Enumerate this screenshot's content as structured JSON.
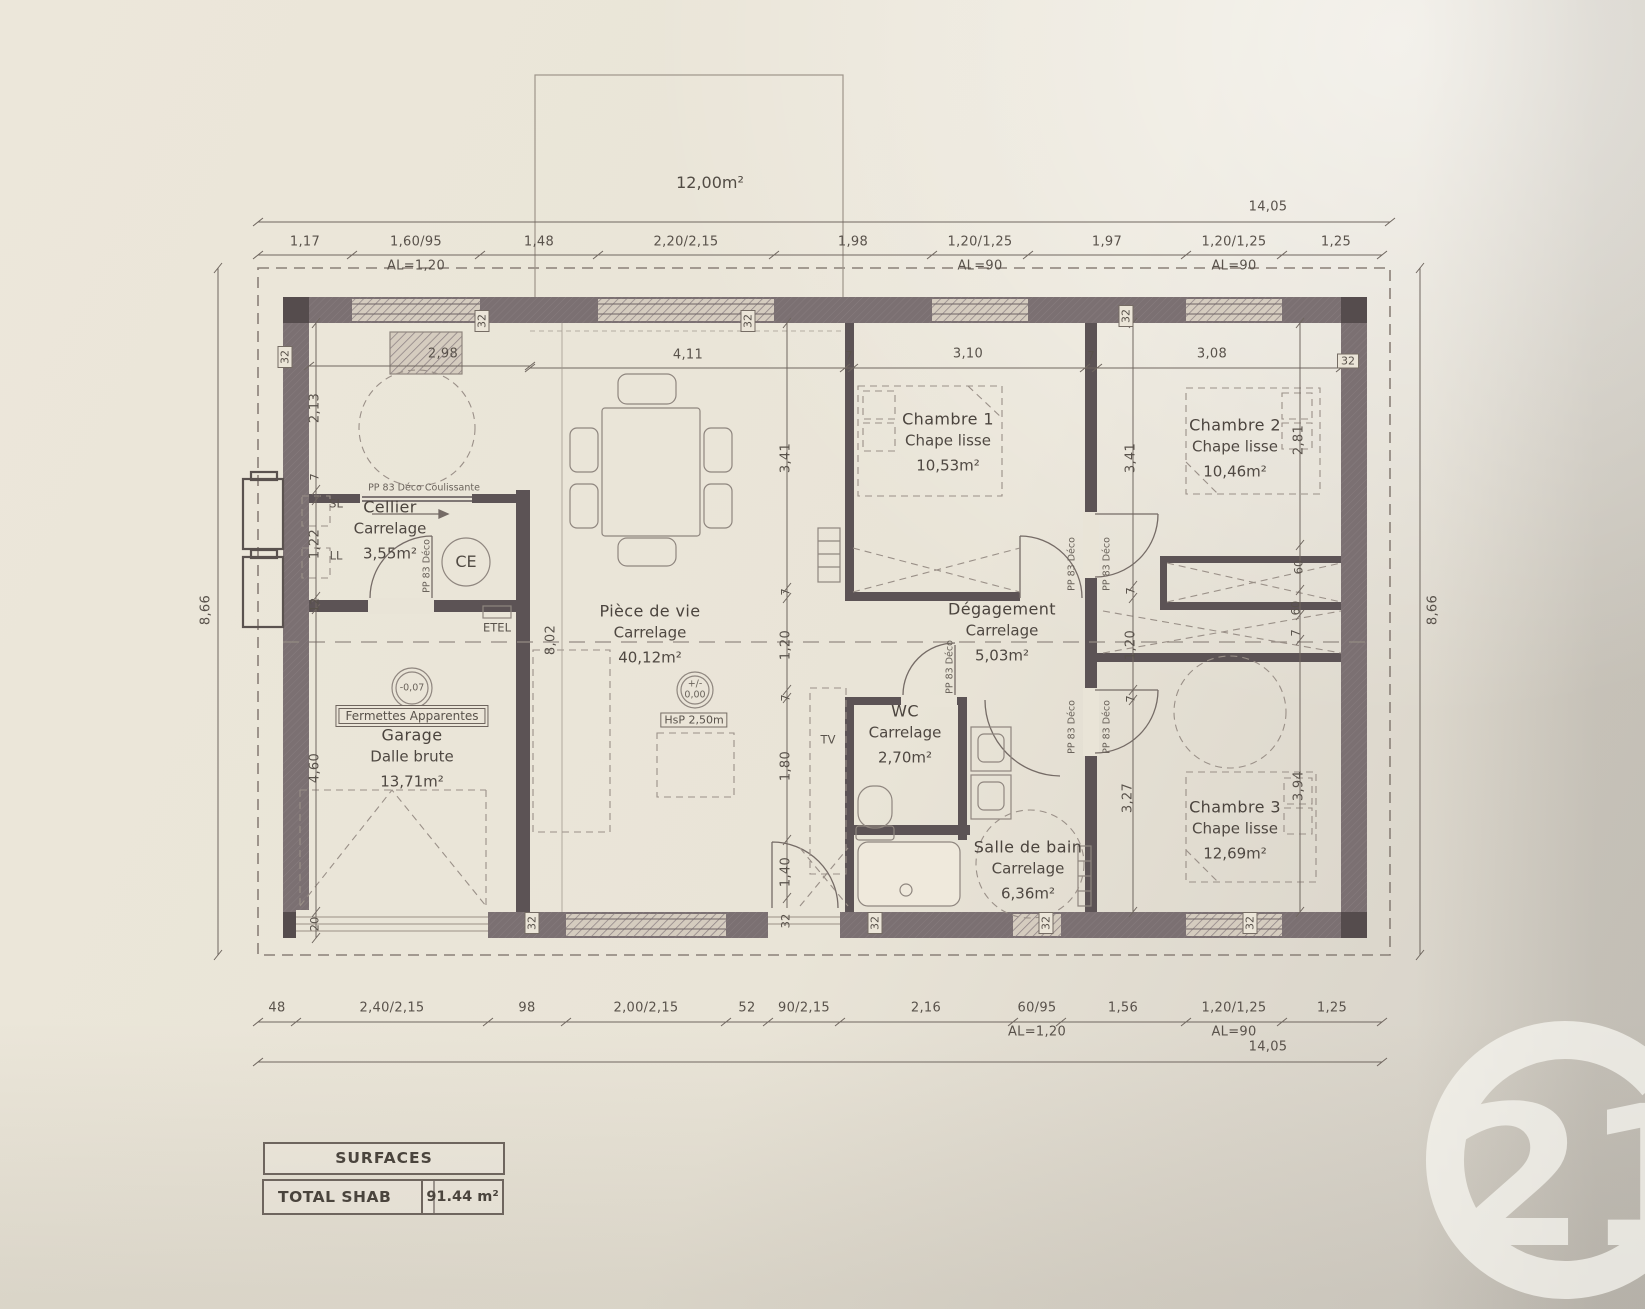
{
  "surfaces_table": {
    "header": "SURFACES",
    "total_label": "TOTAL SHAB",
    "total_value": "91.44 m²"
  },
  "watermark": {
    "number": "21"
  },
  "plan": {
    "terrace_area": "12,00m²",
    "overall_width": "14,05",
    "overall_height": "8,66",
    "rooms": [
      {
        "id": "cellier",
        "name": "Cellier",
        "finish": "Carrelage",
        "area": "3,55m²",
        "cx": 390,
        "cy": 530
      },
      {
        "id": "garage",
        "name": "Garage",
        "finish": "Dalle brute",
        "area": "13,71m²",
        "cx": 412,
        "cy": 758
      },
      {
        "id": "piece-de-vie",
        "name": "Pièce de vie",
        "finish": "Carrelage",
        "area": "40,12m²",
        "cx": 650,
        "cy": 634
      },
      {
        "id": "wc",
        "name": "WC",
        "finish": "Carrelage",
        "area": "2,70m²",
        "cx": 905,
        "cy": 734
      },
      {
        "id": "salle-de-bain",
        "name": "Salle de bain",
        "finish": "Carrelage",
        "area": "6,36m²",
        "cx": 1028,
        "cy": 870
      },
      {
        "id": "degagement",
        "name": "Dégagement",
        "finish": "Carrelage",
        "area": "5,03m²",
        "cx": 1002,
        "cy": 632
      },
      {
        "id": "chambre-1",
        "name": "Chambre 1",
        "finish": "Chape lisse",
        "area": "10,53m²",
        "cx": 948,
        "cy": 442
      },
      {
        "id": "chambre-2",
        "name": "Chambre 2",
        "finish": "Chape lisse",
        "area": "10,46m²",
        "cx": 1235,
        "cy": 448
      },
      {
        "id": "chambre-3",
        "name": "Chambre 3",
        "finish": "Chape lisse",
        "area": "12,69m²",
        "cx": 1235,
        "cy": 830
      }
    ],
    "labels": [
      {
        "t": "12,00m²",
        "x": 710,
        "y": 183,
        "cls": "big",
        "n": "terrace-area-label"
      },
      {
        "t": "14,05",
        "x": 1268,
        "y": 207,
        "n": "overall-width-top"
      },
      {
        "t": "1,17",
        "x": 305,
        "y": 242
      },
      {
        "t": "1,60/95",
        "x": 416,
        "y": 242
      },
      {
        "t": "AL=1,20",
        "x": 416,
        "y": 266
      },
      {
        "t": "1,48",
        "x": 539,
        "y": 242
      },
      {
        "t": "2,20/2,15",
        "x": 686,
        "y": 242
      },
      {
        "t": "1,98",
        "x": 853,
        "y": 242
      },
      {
        "t": "1,20/1,25",
        "x": 980,
        "y": 242
      },
      {
        "t": "AL=90",
        "x": 980,
        "y": 266
      },
      {
        "t": "1,97",
        "x": 1107,
        "y": 242
      },
      {
        "t": "1,20/1,25",
        "x": 1234,
        "y": 242
      },
      {
        "t": "AL=90",
        "x": 1234,
        "y": 266
      },
      {
        "t": "1,25",
        "x": 1336,
        "y": 242
      },
      {
        "t": "48",
        "x": 277,
        "y": 1008
      },
      {
        "t": "2,40/2,15",
        "x": 392,
        "y": 1008
      },
      {
        "t": "98",
        "x": 527,
        "y": 1008
      },
      {
        "t": "2,00/2,15",
        "x": 646,
        "y": 1008
      },
      {
        "t": "52",
        "x": 747,
        "y": 1008
      },
      {
        "t": "90/2,15",
        "x": 804,
        "y": 1008
      },
      {
        "t": "2,16",
        "x": 926,
        "y": 1008
      },
      {
        "t": "60/95",
        "x": 1037,
        "y": 1008
      },
      {
        "t": "AL=1,20",
        "x": 1037,
        "y": 1032
      },
      {
        "t": "1,56",
        "x": 1123,
        "y": 1008
      },
      {
        "t": "1,20/1,25",
        "x": 1234,
        "y": 1008
      },
      {
        "t": "AL=90",
        "x": 1234,
        "y": 1032
      },
      {
        "t": "1,25",
        "x": 1332,
        "y": 1008
      },
      {
        "t": "14,05",
        "x": 1268,
        "y": 1047,
        "n": "overall-width-bottom"
      },
      {
        "t": "8,66",
        "x": 206,
        "y": 610,
        "rot": true,
        "n": "overall-height-left"
      },
      {
        "t": "8,66",
        "x": 1433,
        "y": 610,
        "rot": true,
        "n": "overall-height-right"
      },
      {
        "t": "2,98",
        "x": 443,
        "y": 354
      },
      {
        "t": "4,11",
        "x": 688,
        "y": 355
      },
      {
        "t": "7",
        "x": 849,
        "y": 356,
        "cls": "small"
      },
      {
        "t": "3,10",
        "x": 968,
        "y": 354
      },
      {
        "t": "7",
        "x": 1091,
        "y": 356,
        "cls": "small"
      },
      {
        "t": "3,08",
        "x": 1212,
        "y": 354
      },
      {
        "t": "2,13",
        "x": 315,
        "y": 408,
        "rot": true
      },
      {
        "t": "7",
        "x": 315,
        "y": 477,
        "rot": true,
        "cls": "small"
      },
      {
        "t": "1,22",
        "x": 315,
        "y": 544,
        "rot": true
      },
      {
        "t": "12",
        "x": 315,
        "y": 605,
        "rot": true,
        "cls": "small"
      },
      {
        "t": "4,60",
        "x": 315,
        "y": 768,
        "rot": true
      },
      {
        "t": "20",
        "x": 315,
        "y": 924,
        "rot": true,
        "cls": "small"
      },
      {
        "t": "3,41",
        "x": 786,
        "y": 458,
        "rot": true
      },
      {
        "t": "7",
        "x": 786,
        "y": 592,
        "rot": true,
        "cls": "small"
      },
      {
        "t": "1,20",
        "x": 786,
        "y": 645,
        "rot": true
      },
      {
        "t": "7",
        "x": 786,
        "y": 698,
        "rot": true,
        "cls": "small"
      },
      {
        "t": "1,80",
        "x": 786,
        "y": 766,
        "rot": true
      },
      {
        "t": "1,40",
        "x": 786,
        "y": 872,
        "rot": true
      },
      {
        "t": "32",
        "x": 786,
        "y": 921,
        "rot": true,
        "cls": "small"
      },
      {
        "t": "3,41",
        "x": 1131,
        "y": 458,
        "rot": true
      },
      {
        "t": "7",
        "x": 1131,
        "y": 591,
        "rot": true,
        "cls": "small"
      },
      {
        "t": "1,20",
        "x": 1131,
        "y": 645,
        "rot": true
      },
      {
        "t": "7",
        "x": 1131,
        "y": 699,
        "rot": true,
        "cls": "small"
      },
      {
        "t": "3,27",
        "x": 1128,
        "y": 798,
        "rot": true
      },
      {
        "t": "2,81",
        "x": 1299,
        "y": 440,
        "rot": true
      },
      {
        "t": "60",
        "x": 1299,
        "y": 567,
        "rot": true,
        "cls": "small"
      },
      {
        "t": "60",
        "x": 1296,
        "y": 608,
        "rot": true,
        "cls": "small"
      },
      {
        "t": "7",
        "x": 1296,
        "y": 633,
        "rot": true,
        "cls": "small"
      },
      {
        "t": "3,94",
        "x": 1299,
        "y": 786,
        "rot": true
      },
      {
        "t": "8,02",
        "x": 551,
        "y": 640,
        "rot": true
      },
      {
        "t": "32",
        "x": 285,
        "y": 357,
        "rot": true,
        "cls": "boxed",
        "n": "wall-thickness-marker"
      },
      {
        "t": "32",
        "x": 482,
        "y": 321,
        "rot": true,
        "cls": "boxed",
        "n": "wall-thickness-marker"
      },
      {
        "t": "32",
        "x": 748,
        "y": 321,
        "rot": true,
        "cls": "boxed",
        "n": "wall-thickness-marker"
      },
      {
        "t": "32",
        "x": 1126,
        "y": 316,
        "rot": true,
        "cls": "boxed",
        "n": "wall-thickness-marker"
      },
      {
        "t": "32",
        "x": 1348,
        "y": 361,
        "cls": "boxed",
        "n": "wall-thickness-marker"
      },
      {
        "t": "32",
        "x": 532,
        "y": 923,
        "rot": true,
        "cls": "boxed",
        "n": "wall-thickness-marker"
      },
      {
        "t": "32",
        "x": 875,
        "y": 923,
        "rot": true,
        "cls": "boxed",
        "n": "wall-thickness-marker"
      },
      {
        "t": "32",
        "x": 1046,
        "y": 923,
        "rot": true,
        "cls": "boxed",
        "n": "wall-thickness-marker"
      },
      {
        "t": "32",
        "x": 1250,
        "y": 923,
        "rot": true,
        "cls": "boxed",
        "n": "wall-thickness-marker"
      },
      {
        "t": "PP 83 Déco Coulissante",
        "x": 424,
        "y": 488,
        "cls": "tiny",
        "n": "sliding-door-label"
      },
      {
        "t": "PP 83 Déco",
        "x": 427,
        "y": 566,
        "rot": true,
        "cls": "tiny",
        "n": "door-label"
      },
      {
        "t": "PP 83 Déco",
        "x": 950,
        "y": 667,
        "rot": true,
        "cls": "tiny",
        "n": "door-label"
      },
      {
        "t": "PP 83 Déco",
        "x": 1072,
        "y": 564,
        "rot": true,
        "cls": "tiny",
        "n": "door-label"
      },
      {
        "t": "PP 83 Déco",
        "x": 1107,
        "y": 564,
        "rot": true,
        "cls": "tiny",
        "n": "door-label"
      },
      {
        "t": "PP 83 Déco",
        "x": 1072,
        "y": 727,
        "rot": true,
        "cls": "tiny",
        "n": "door-label"
      },
      {
        "t": "PP 83 Déco",
        "x": 1107,
        "y": 727,
        "rot": true,
        "cls": "tiny",
        "n": "door-label"
      },
      {
        "t": "SL",
        "x": 336,
        "y": 504,
        "cls": "small",
        "n": "washer-label"
      },
      {
        "t": "LL",
        "x": 336,
        "y": 556,
        "cls": "small",
        "n": "dryer-label"
      },
      {
        "t": "CE",
        "x": 466,
        "y": 562,
        "cls": "big",
        "n": "water-heater-label"
      },
      {
        "t": "ETEL",
        "x": 497,
        "y": 628,
        "cls": "small",
        "n": "electrical-panel-label"
      },
      {
        "t": "TV",
        "x": 828,
        "y": 740,
        "cls": "small",
        "n": "tv-label"
      },
      {
        "t": "-0,07",
        "x": 412,
        "y": 688,
        "cls": "tiny",
        "n": "level-marker"
      },
      {
        "t": "+/-",
        "x": 695,
        "y": 684,
        "cls": "tiny",
        "n": "level-marker"
      },
      {
        "t": "0,00",
        "x": 695,
        "y": 695,
        "cls": "tiny",
        "n": "level-marker"
      },
      {
        "t": "HsP 2,50m",
        "x": 694,
        "y": 720,
        "cls": "boxed",
        "n": "ceiling-height-label"
      },
      {
        "t": "Fermettes Apparentes",
        "x": 412,
        "y": 716,
        "cls": "boxed2",
        "n": "roof-truss-label"
      }
    ]
  }
}
